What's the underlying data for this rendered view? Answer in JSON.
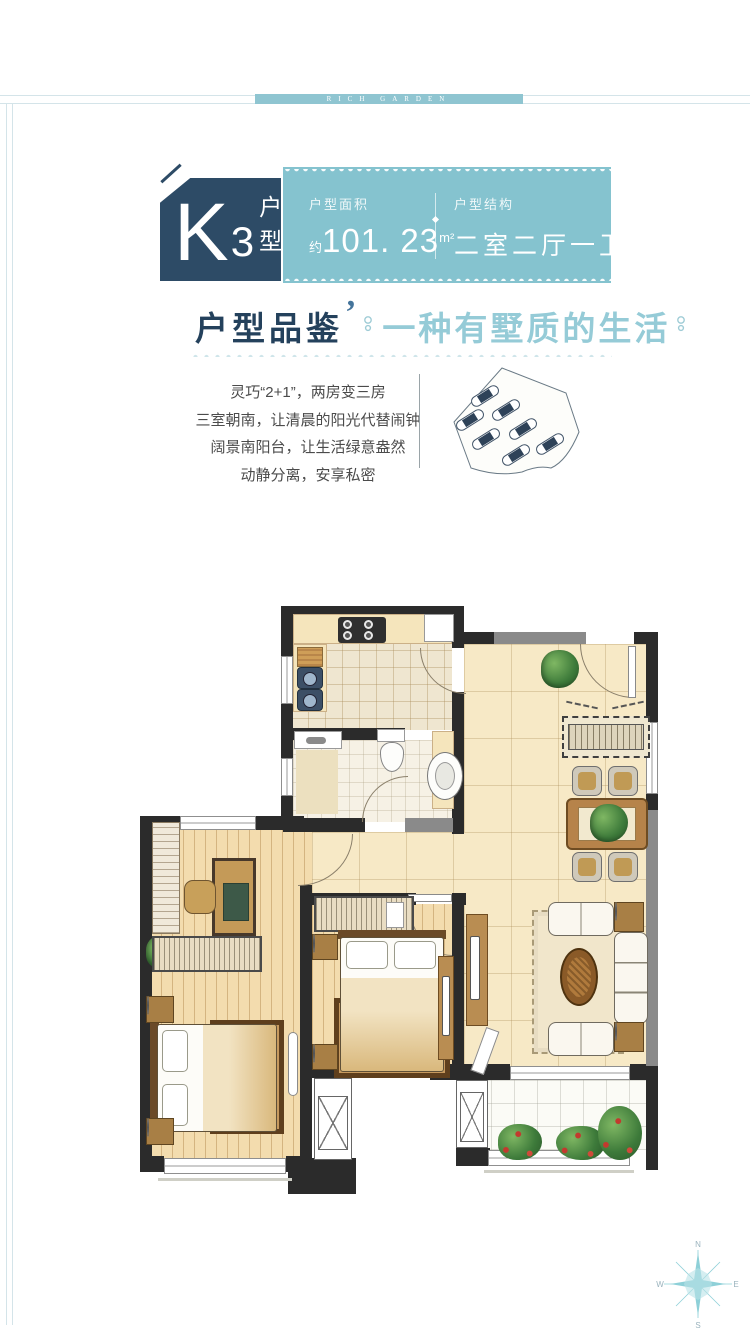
{
  "banner": {
    "text": "RICH GARDEN"
  },
  "header": {
    "badge": {
      "k": "K",
      "num": "3",
      "suffix": "户型"
    },
    "area": {
      "label": "户型面积",
      "prefix": "约",
      "value": "101. 23",
      "unit": "m²"
    },
    "structure": {
      "label": "户型结构",
      "value": "二室二厅一卫"
    }
  },
  "section": {
    "title": "户型品鉴",
    "quote": "’",
    "subtitle": "一种有墅质的生活",
    "lines": [
      "灵巧“2+1”，两房变三房",
      "三室朝南，让清晨的阳光代替闹钟",
      "阔景南阳台，让生活绿意盎然",
      "动静分离，安享私密"
    ]
  },
  "compass": {
    "n": "N",
    "e": "E",
    "s": "S",
    "w": "W"
  },
  "colors": {
    "teal": "#85c3cf",
    "navy": "#2d4b66",
    "title": "#24415c",
    "subtitle": "#95cbd7",
    "body_text": "#4b4b4b",
    "wall": "#2b2b2b",
    "wall_gray": "#8a8a8a",
    "floor_beige": "#f7e9c7",
    "floor_wood": "#f3dcae",
    "accent_wave": "#cfe5ea"
  }
}
